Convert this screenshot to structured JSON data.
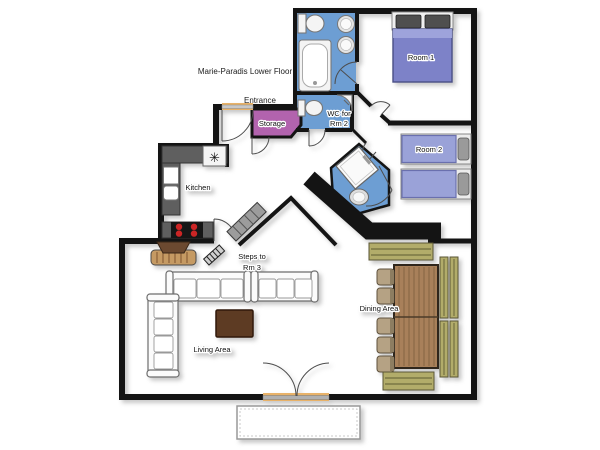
{
  "title": "Marie-Paradis Lower Floor",
  "labels": {
    "entrance": "Entrance",
    "storage": "Storage",
    "wc_line1": "WC for",
    "wc_line2": "Rm 2",
    "room1": "Room 1",
    "room2": "Room 2",
    "kitchen": "Kitchen",
    "steps_line1": "Steps to",
    "steps_line2": "Rm 3",
    "living": "Living Area",
    "dining": "Dining Area"
  },
  "icons": {
    "kitchen_vent_glyph": "✳"
  },
  "colors": {
    "floor": "#e8b269",
    "wet_room_floor": "#6d9ed3",
    "storage_floor": "#b263ae",
    "wall": "#141414",
    "double_bed": "#7d82c8",
    "single_bed": "#9aa2d8",
    "bench_wood": "#b2ac6a",
    "table_wood": "#a8805a",
    "coffee_table": "#5d3b23",
    "kitchen_counter": "#5f5f5f",
    "stove_burner": "#cc2525",
    "stairs": "#9c9c9c",
    "terrace_border": "#999999"
  }
}
